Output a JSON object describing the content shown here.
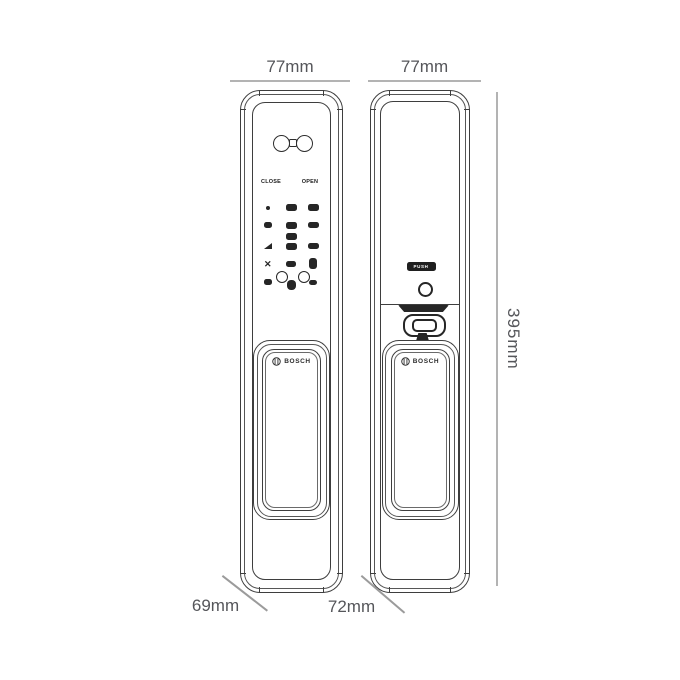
{
  "dimensions": {
    "front_width": "77mm",
    "back_width": "77mm",
    "height": "395mm",
    "front_depth": "69mm",
    "back_depth": "72mm"
  },
  "front_panel": {
    "close_label": "CLOSE",
    "open_label": "OPEN",
    "brand_label": "BOSCH"
  },
  "back_panel": {
    "push_label": "PUSH",
    "brand_label": "BOSCH"
  },
  "colors": {
    "linework": "#3e3e3e",
    "keypad_dark": "#262626",
    "dimension_line": "#b3b3b3",
    "dimension_text": "#55565a",
    "leader_line": "#9b9b9b",
    "background": "#ffffff"
  }
}
